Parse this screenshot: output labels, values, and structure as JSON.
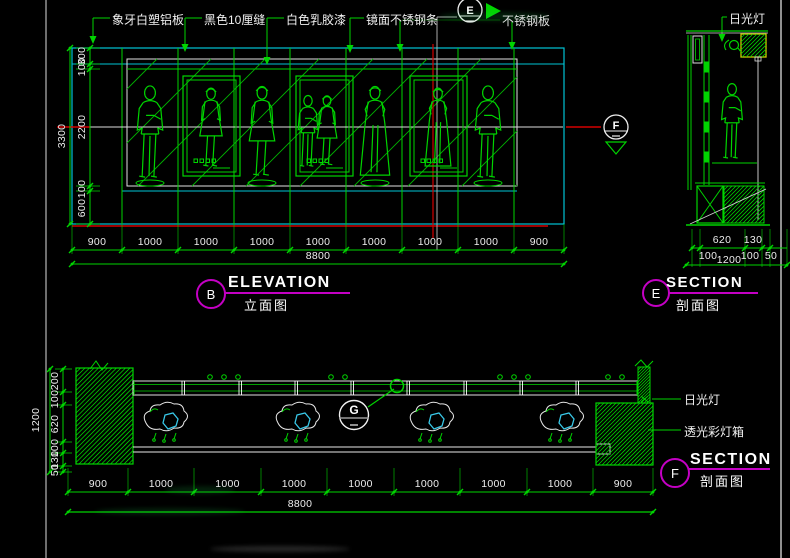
{
  "colors": {
    "green": "#00d400",
    "dim_green": "#00b000",
    "cyan": "#00c3d4",
    "red": "#d40000",
    "magenta": "#c400c4",
    "white": "#ededed",
    "gray": "#9a9a9a",
    "yellow": "#cfcf00",
    "fixture_cyan": "#39c8e8"
  },
  "callouts": {
    "top": [
      "象牙白塑铝板",
      "黑色10厘缝",
      "白色乳胶漆",
      "镜面不锈钢条",
      "不锈钢板"
    ],
    "top_right": "日光灯",
    "bottom_right_1": "日光灯",
    "bottom_right_2": "透光彩灯箱"
  },
  "views": {
    "elevation": {
      "marker": "B",
      "title": "ELEVATION",
      "subtitle": "立面图"
    },
    "section_e": {
      "marker": "E",
      "title": "SECTION",
      "subtitle": "剖面图"
    },
    "section_f": {
      "marker": "F",
      "title": "SECTION",
      "subtitle": "剖面图"
    }
  },
  "cut_markers": {
    "e": "E",
    "f": "F",
    "g": "G"
  },
  "dims": {
    "elevation_bottom": {
      "segments": [
        "900",
        "1000",
        "1000",
        "1000",
        "1000",
        "1000",
        "1000",
        "1000",
        "900"
      ],
      "total": "8800"
    },
    "elevation_left": {
      "segments": [
        "300",
        "100",
        "2200",
        "100",
        "600"
      ],
      "total": "3300"
    },
    "section_e_row1": [
      "620",
      "130"
    ],
    "section_e_row2": [
      "100",
      "1200",
      "100",
      "50"
    ],
    "section_f_left": {
      "segments": [
        "200",
        "100",
        "620",
        "100",
        "130",
        "50"
      ],
      "total": "1200"
    },
    "section_f_bottom": {
      "segments": [
        "900",
        "1000",
        "1000",
        "1000",
        "1000",
        "1000",
        "1000",
        "1000",
        "900"
      ],
      "total": "8800"
    }
  }
}
